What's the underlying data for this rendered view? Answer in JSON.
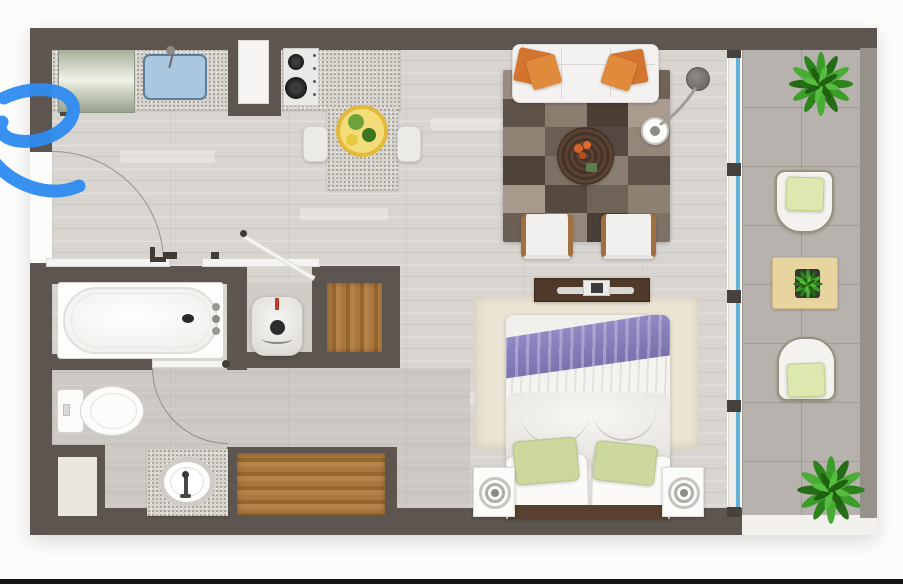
{
  "scene": {
    "type": "apartment-studio-floor-plan",
    "view": "top-down-3d-render",
    "visible_text": "none",
    "annotation": {
      "kind": "hand-drawn-pen-scribble",
      "color": "#2e8cf0",
      "position": "left-edge-over-entry"
    }
  },
  "palette": {
    "wall": "#5d5650",
    "balcony_wall": "#96918b",
    "floor_wood": "#d8d5d1",
    "balcony_tile": "#b7b2ad",
    "counter_speckle": "#d6d2cc",
    "glass_door": "#64b0d6",
    "accent_orange": "#d3752f",
    "accent_purple": "#8078b5",
    "accent_green_pillow": "#cdd89f",
    "wood_closet": "#a5743c",
    "rug_cream": "#eae4d4",
    "scribble_blue": "#2e8cf0",
    "bottom_bar": "#161616"
  },
  "rug_colors": [
    "#9a8c80",
    "#7a6c60",
    "#8d8073",
    "#6f6256",
    "#5f5248",
    "#8a7d70",
    "#4a3e35",
    "#a99c8f",
    "#8f8275",
    "#6b5e52",
    "#564941",
    "#948779",
    "#4e4238",
    "#7d7064",
    "#8a7d71",
    "#5f5349",
    "#a79a8d",
    "#564a40",
    "#6f6357",
    "#8d8174",
    "#6b5f54",
    "#93867a",
    "#4a3f36",
    "#7e7266"
  ],
  "rooms": {
    "kitchen": {
      "items": [
        "refrigerator",
        "kitchen-sink",
        "granite-countertop",
        "pantry-column",
        "stove-two-burner",
        "breakfast-bar",
        "fruit-plate",
        "bar-stool-left",
        "bar-stool-right"
      ]
    },
    "living": {
      "items": [
        "sofa-three-seat",
        "orange-throw-pillows",
        "patchwork-rug",
        "round-coffee-table",
        "arc-floor-lamp",
        "armchair-left",
        "armchair-right"
      ]
    },
    "bedroom": {
      "items": [
        "tv-console",
        "flat-tv",
        "cream-shag-rug",
        "double-bed",
        "purple-throw",
        "knit-blanket",
        "green-pillows",
        "white-pillows",
        "headboard",
        "nightstand-left",
        "nightstand-right"
      ]
    },
    "bathroom": {
      "items": [
        "bathtub",
        "toilet",
        "vanity-sink",
        "water-heater",
        "storage-niche",
        "bathroom-door"
      ]
    },
    "storage": {
      "items": [
        "center-wood-closet",
        "bottom-wood-closet"
      ]
    },
    "balcony": {
      "items": [
        "sliding-glass-door",
        "potted-plant-top",
        "lounge-chair-top",
        "side-table",
        "table-plant",
        "lounge-chair-bottom",
        "potted-plant-bottom"
      ]
    }
  }
}
